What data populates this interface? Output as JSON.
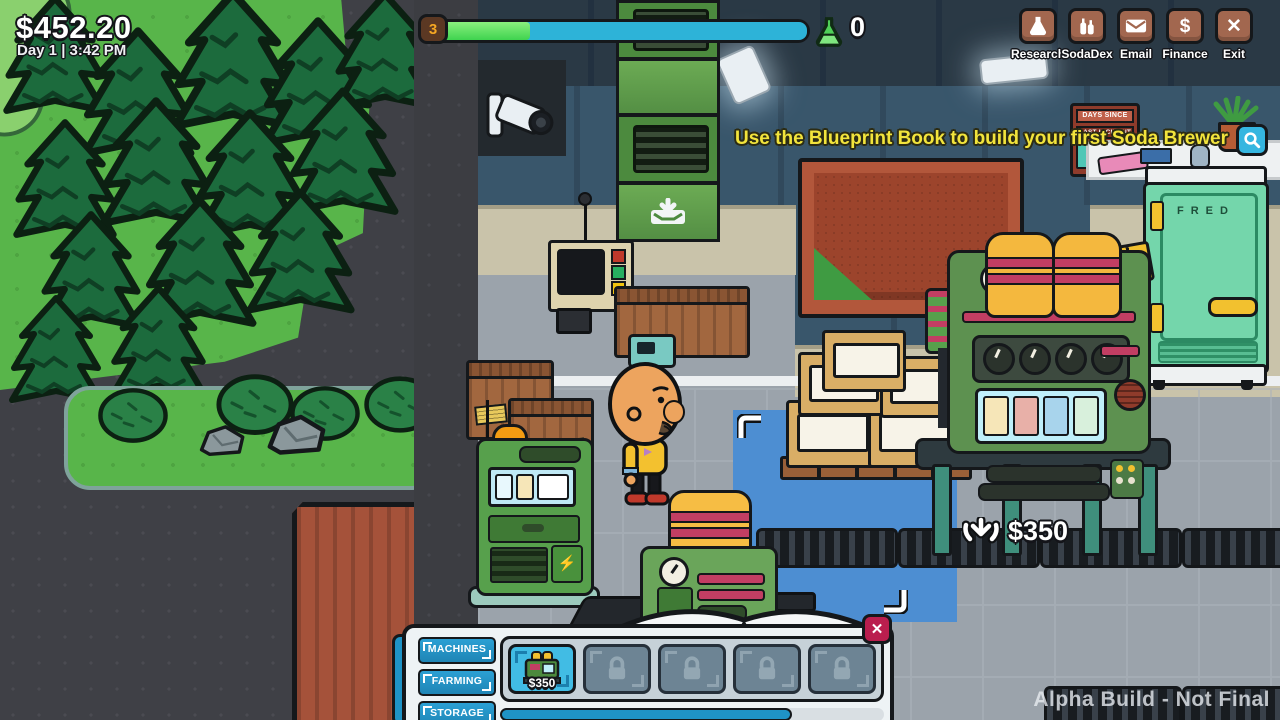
{
  "hud": {
    "money": "$452.20",
    "datetime": "Day 1 | 3:42 PM",
    "xp": {
      "level": "3",
      "counter": "0",
      "progress_pct": 27
    },
    "toolbar": [
      {
        "label": "Research",
        "icon": "flask-icon"
      },
      {
        "label": "SodaDex",
        "icon": "bottles-icon"
      },
      {
        "label": "Email",
        "icon": "envelope-icon"
      },
      {
        "label": "Finance",
        "icon": "dollar-icon"
      },
      {
        "label": "Exit",
        "icon": "x-icon"
      }
    ],
    "tutorial_text": "Use the Blueprint Book to build your first Soda Brewer",
    "watermark": "Alpha Build - Not Final"
  },
  "scene": {
    "incident_sign": {
      "line1": "DAYS SINCE",
      "line2": "LAST INCIDENT"
    },
    "fridge_label": "FRED",
    "placement_price": "$350"
  },
  "blueprint_book": {
    "tabs": [
      {
        "label": "MACHINES"
      },
      {
        "label": "FARMING"
      },
      {
        "label": "STORAGE"
      }
    ],
    "slots": [
      {
        "type": "item",
        "name": "soda-brewer",
        "price": "$350"
      },
      {
        "type": "locked"
      },
      {
        "type": "locked"
      },
      {
        "type": "locked"
      },
      {
        "type": "locked"
      }
    ]
  },
  "icons": {
    "finance_glyph": "$",
    "exit_glyph": "✕",
    "close_glyph": "✕",
    "lightning_glyph": "⚡"
  },
  "colors": {
    "accent_cyan": "#2ba4d8",
    "xp_green": "#3fd34f",
    "tutorial_yellow": "#f2e43c",
    "button_brown": "#a2674f",
    "close_red": "#ba1e4e",
    "mat_blue": "#4d8ed2"
  }
}
